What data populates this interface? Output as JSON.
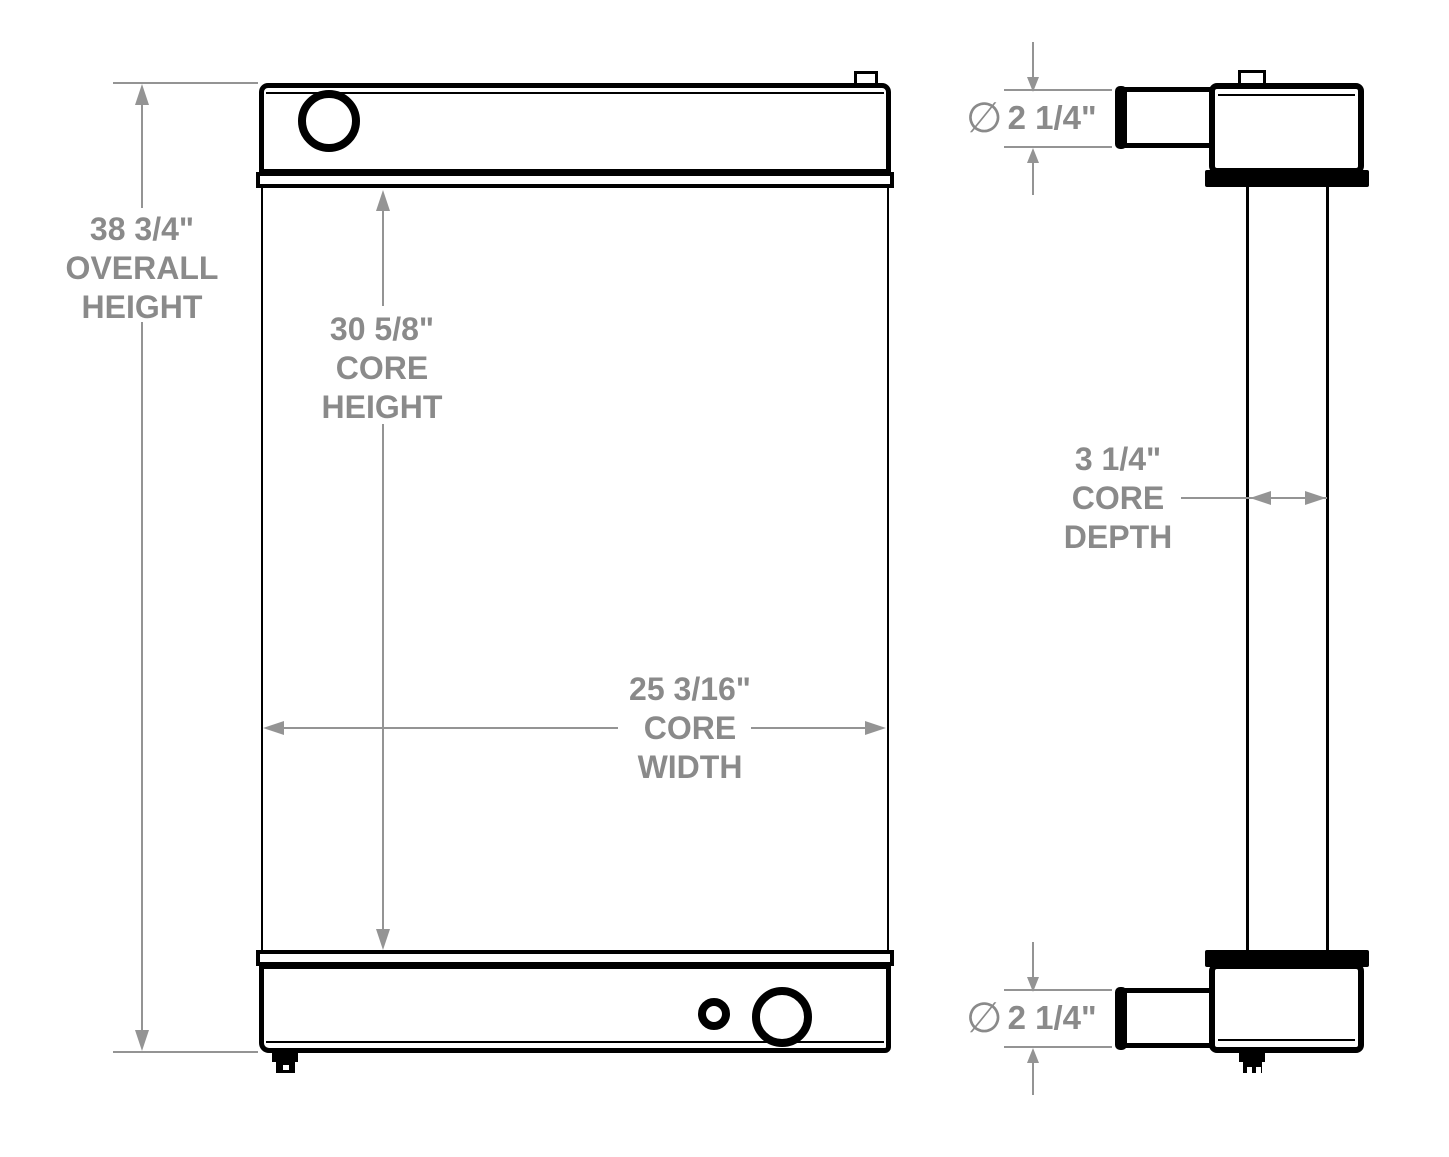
{
  "dims": {
    "overall_height": {
      "lines": [
        "38 3/4\"",
        "OVERALL",
        "HEIGHT"
      ]
    },
    "core_height": {
      "lines": [
        "30 5/8\"",
        "CORE",
        "HEIGHT"
      ]
    },
    "core_width": {
      "lines": [
        "25 3/16\"",
        "CORE",
        "WIDTH"
      ]
    },
    "core_depth": {
      "lines": [
        "3 1/4\"",
        "CORE",
        "DEPTH"
      ]
    },
    "top_port": {
      "symbol": "∅",
      "value": "2 1/4\""
    },
    "bottom_port": {
      "symbol": "∅",
      "value": "2 1/4\""
    }
  },
  "colors": {
    "line": "#000000",
    "dimension": "#8A8A8A",
    "background": "#FFFFFF"
  }
}
